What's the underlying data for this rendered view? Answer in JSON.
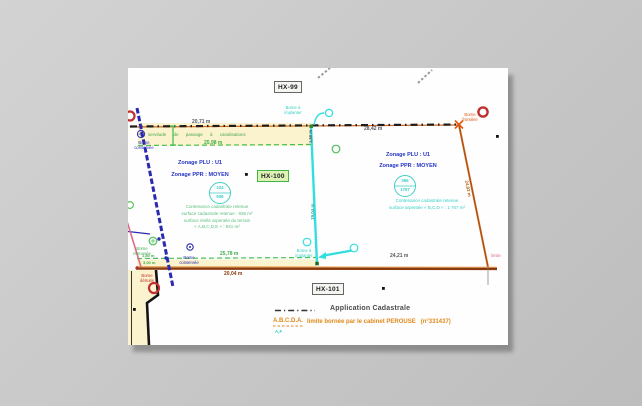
{
  "sections": {
    "hx99": "HX-99",
    "hx100": "HX-100",
    "hx101": "HX-101"
  },
  "parcels": {
    "left": {
      "zonage_plu": "Zonage PLU : U1",
      "zonage_ppr": "Zonage PPR : MOYEN",
      "parcel_number": "224",
      "parcel_area": "936",
      "notes": [
        "Contenance cadastrale retenue",
        "surface cadastrale retenue : 936 m²",
        "surface réelle arpentée du terrain",
        "« A,B,C,D,E » : 941 m²"
      ]
    },
    "right": {
      "zonage_plu": "Zonage PLU : U1",
      "zonage_ppr": "Zonage PPR : MOYEN",
      "parcel_number": "365",
      "parcel_area": "1757",
      "notes": [
        "Contenance cadastrale retenue",
        "surface arpentée « B,C,D » : 1 757 m²"
      ]
    }
  },
  "servitude_note": "servitude de passage à canalisations",
  "measurements": {
    "top_left": "20,71 m",
    "band": "25,98 m",
    "top_right": "28,42 m",
    "cyan_top": "1,50 m",
    "cyan_mid": "19,04 m",
    "right_diag": "24,82 m",
    "bottom_green": "25,78 m",
    "bottom_brown": "20,04 m",
    "bottom_right": "24,21 m",
    "small_1": "1,80 m",
    "small_2": "3,00 m"
  },
  "bornes": {
    "conservee": "Borne conservée",
    "retrouvee": "Borne retrouvée",
    "frontiere": "Borne frontière",
    "a_implanter": "Borne à implanter",
    "detruite": "Borne détruite"
  },
  "corner_note": "limite",
  "legend": {
    "cadastrale": "Application Cadastrale",
    "points": "A.B.C.D.A.",
    "limite": "limite bornée par le cabinet PEROUSE   (n°331437)",
    "partial": "A,F"
  },
  "colors": {
    "orange": "#d2691e",
    "cyan": "#35dede",
    "green": "#4bbf55",
    "blue": "#2a2ab0",
    "red": "#c03030",
    "yellow": "#faf3cd"
  }
}
